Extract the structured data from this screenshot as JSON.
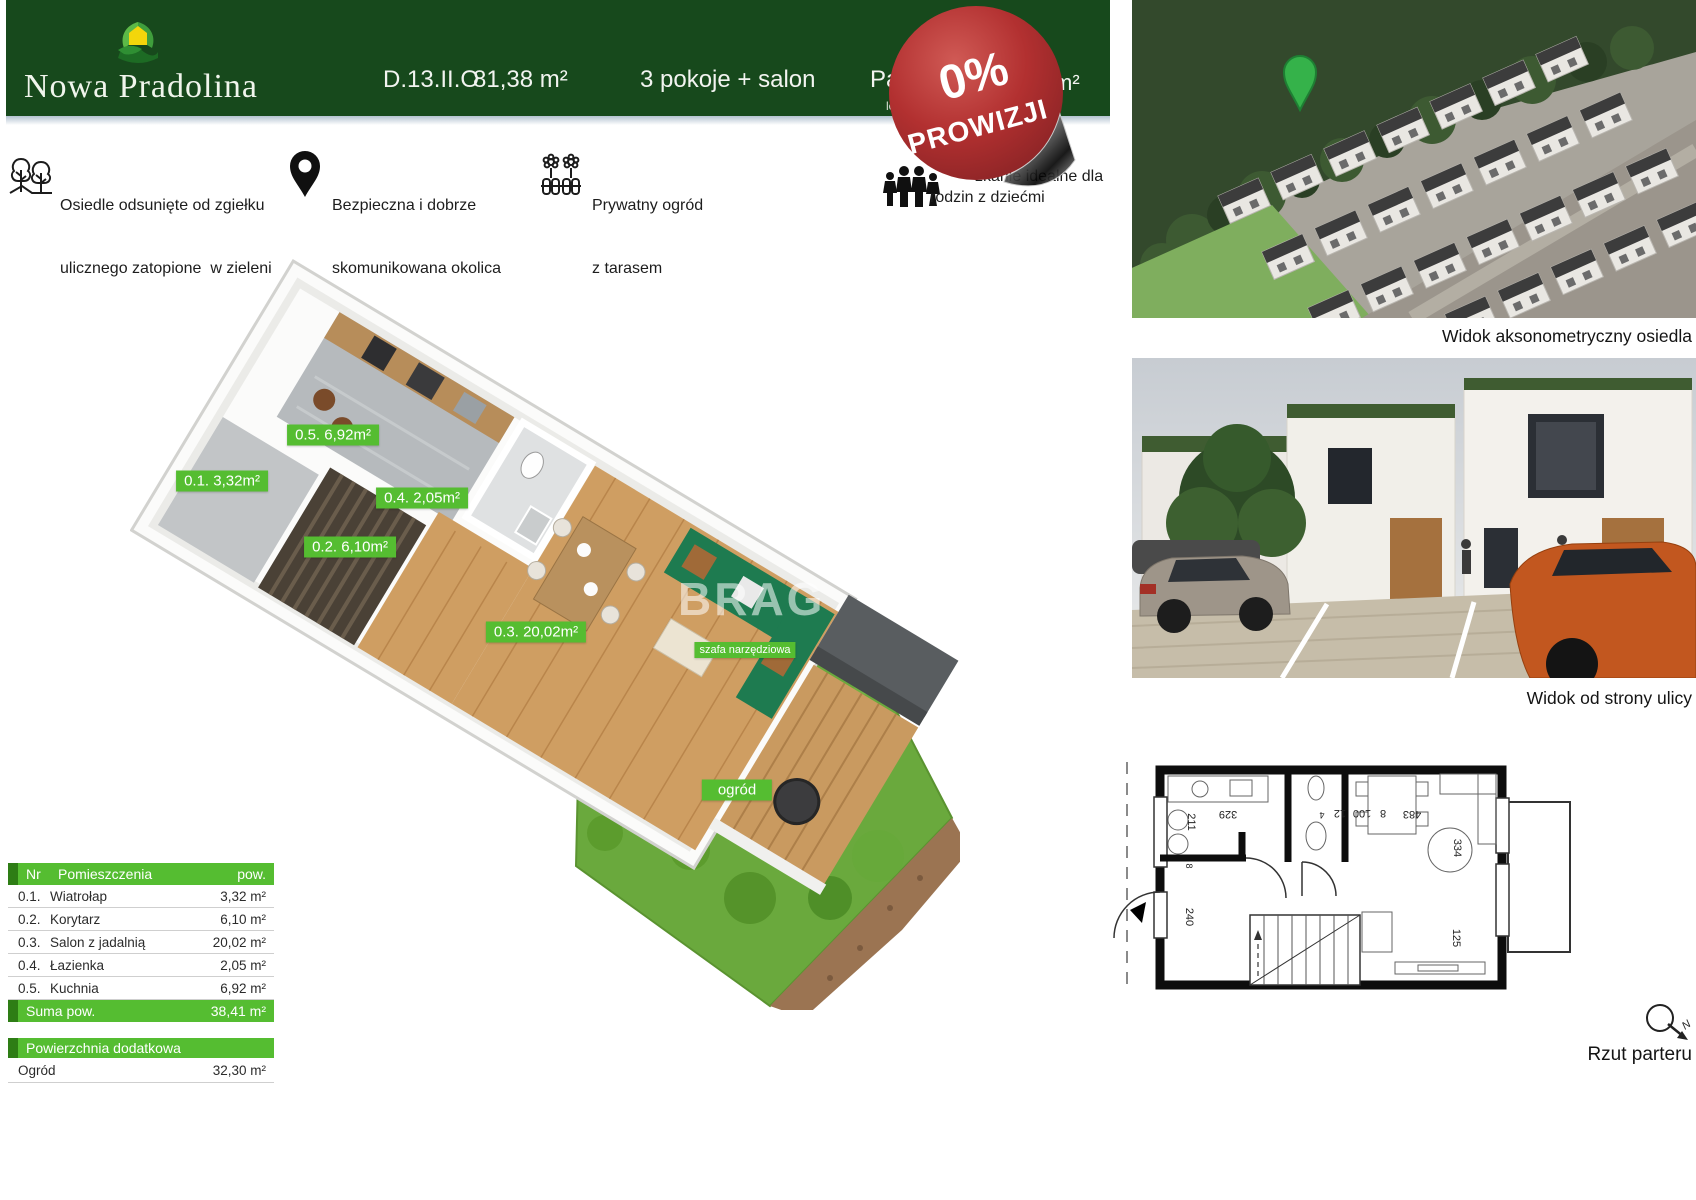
{
  "header": {
    "brand": "Nowa Pradolina",
    "unit_id": "D.13.II.O",
    "area": "81,38 m²",
    "rooms": "3 pokoje + salon",
    "floor_partial": "Pa",
    "floor_sub_partial": "lok",
    "right_partial": "m²"
  },
  "badge": {
    "line1": "0%",
    "line2": "PROWIZJI"
  },
  "features": [
    {
      "icon": "trees-icon",
      "line1": "Osiedle odsunięte od zgiełku",
      "line2": "ulicznego zatopione  w zieleni"
    },
    {
      "icon": "pin-icon",
      "line1": "Bezpieczna i dobrze",
      "line2": "skomunikowana okolica"
    },
    {
      "icon": "garden-icon",
      "line1": "Prywatny ogród",
      "line2": "z tarasem"
    },
    {
      "icon": "family-icon",
      "line1": "zkanie idealne dla",
      "line2": "rodzin z dziećmi"
    }
  ],
  "floorplan3d": {
    "labels": [
      {
        "text": "0.5. 6,92m²"
      },
      {
        "text": "0.1. 3,32m²"
      },
      {
        "text": "0.4. 2,05m²"
      },
      {
        "text": "0.2. 6,10m²"
      },
      {
        "text": "0.3. 20,02m²"
      }
    ],
    "shed_label": "szafa narzędziowa",
    "garden_label": "ogród",
    "watermark": "BRAG"
  },
  "room_table": {
    "header": {
      "nr": "Nr",
      "name": "Pomieszczenia",
      "area": "pow."
    },
    "rows": [
      {
        "nr": "0.1.",
        "name": "Wiatrołap",
        "area": "3,32 m²"
      },
      {
        "nr": "0.2.",
        "name": "Korytarz",
        "area": "6,10 m²"
      },
      {
        "nr": "0.3.",
        "name": "Salon z jadalnią",
        "area": "20,02 m²"
      },
      {
        "nr": "0.4.",
        "name": "Łazienka",
        "area": "2,05 m²"
      },
      {
        "nr": "0.5.",
        "name": "Kuchnia",
        "area": "6,92 m²"
      }
    ],
    "sum_label": "Suma pow.",
    "sum_value": "38,41 m²",
    "extra_header": "Powierzchnia dodatkowa",
    "extra_row": {
      "name": "Ogród",
      "area": "32,30 m²"
    }
  },
  "right_panel": {
    "axon_caption": "Widok aksonometryczny osiedla",
    "street_caption": "Widok od strony ulicy",
    "plan_caption": "Rzut parteru",
    "compass_letter": "N",
    "plan_dims": {
      "d329": "329",
      "d211": "211",
      "d4": "4",
      "d12": "12",
      "d100": "100",
      "d8": "8",
      "d8b": "8",
      "d483": "483",
      "d334": "334",
      "d240": "240",
      "d125": "125"
    }
  },
  "colors": {
    "header_green": "#17491c",
    "accent_green": "#55bd31",
    "badge_red": "#b23030"
  }
}
